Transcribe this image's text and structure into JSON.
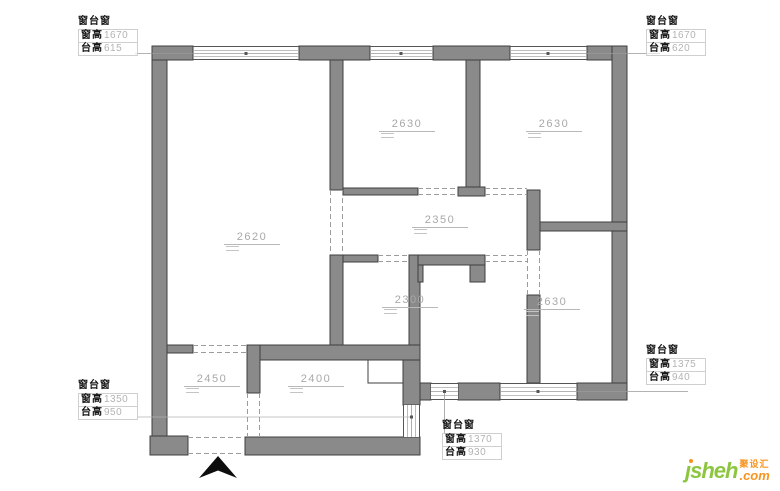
{
  "colors": {
    "wall_fill": "#8a8a8a",
    "wall_stroke": "#3f3f3f",
    "dim_text": "#a8a8a8",
    "logo_green": "#8CC63F",
    "logo_orange": "#F7941E"
  },
  "window_labels": [
    {
      "id": "top-left",
      "title": "窗台窗",
      "rows": [
        {
          "k": "窗高",
          "v": "1670"
        },
        {
          "k": "台高",
          "v": "615"
        }
      ]
    },
    {
      "id": "top-right",
      "title": "窗台窗",
      "rows": [
        {
          "k": "窗高",
          "v": "1670"
        },
        {
          "k": "台高",
          "v": "620"
        }
      ]
    },
    {
      "id": "right-middle",
      "title": "窗台窗",
      "rows": [
        {
          "k": "窗高",
          "v": "1375"
        },
        {
          "k": "台高",
          "v": "940"
        }
      ]
    },
    {
      "id": "bottom-left",
      "title": "窗台窗",
      "rows": [
        {
          "k": "窗高",
          "v": "1350"
        },
        {
          "k": "台高",
          "v": "950"
        }
      ]
    },
    {
      "id": "bottom-center",
      "title": "窗台窗",
      "rows": [
        {
          "k": "窗高",
          "v": "1370"
        },
        {
          "k": "台高",
          "v": "930"
        }
      ]
    }
  ],
  "room_dims": [
    {
      "id": "living-room",
      "value": "2620"
    },
    {
      "id": "bedroom-top-middle",
      "value": "2630"
    },
    {
      "id": "bedroom-top-right",
      "value": "2630"
    },
    {
      "id": "hallway",
      "value": "2350"
    },
    {
      "id": "room-middle",
      "value": "2300"
    },
    {
      "id": "bedroom-bottom-right",
      "value": "2630"
    },
    {
      "id": "entry",
      "value": "2450"
    },
    {
      "id": "kitchen",
      "value": "2400"
    }
  ],
  "logo": {
    "brand": "jsheh",
    "brand_glyphs": "ȷsheh",
    "cn": "聚设汇",
    "tld": ".com"
  }
}
